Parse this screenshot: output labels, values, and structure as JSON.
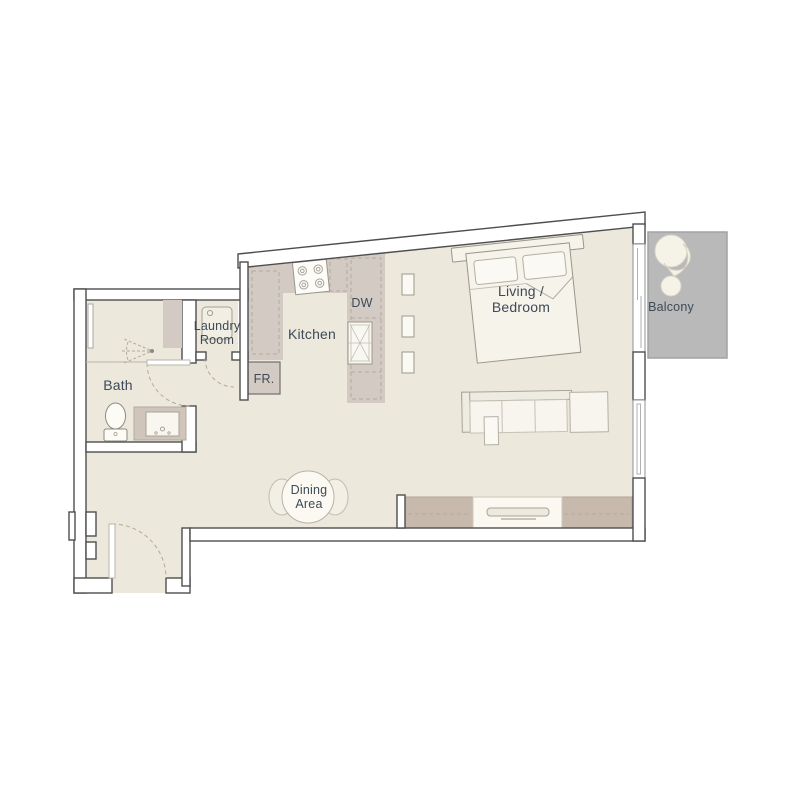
{
  "palette": {
    "floor": "#ECE8DC",
    "counter": "#D3CBC3",
    "console": "#C7BAAD",
    "balcony": "#B9B9B9",
    "wall_fill": "#FFFFFF",
    "wall_line": "#4E4E50",
    "furniture_fill": "#F6F3EA",
    "furniture_line": "#9A968A",
    "dash": "#B3A99C",
    "label": "#3E4A57"
  },
  "rooms": {
    "bath": {
      "label": "Bath"
    },
    "laundry": {
      "line1": "Laundry",
      "line2": "Room"
    },
    "kitchen": {
      "label": "Kitchen"
    },
    "living_bedroom": {
      "line1": "Living /",
      "line2": "Bedroom"
    },
    "dining": {
      "line1": "Dining",
      "line2": "Area"
    },
    "balcony": {
      "label": "Balcony"
    }
  },
  "fixtures": {
    "dishwasher": "DW",
    "fridge": "FR."
  }
}
